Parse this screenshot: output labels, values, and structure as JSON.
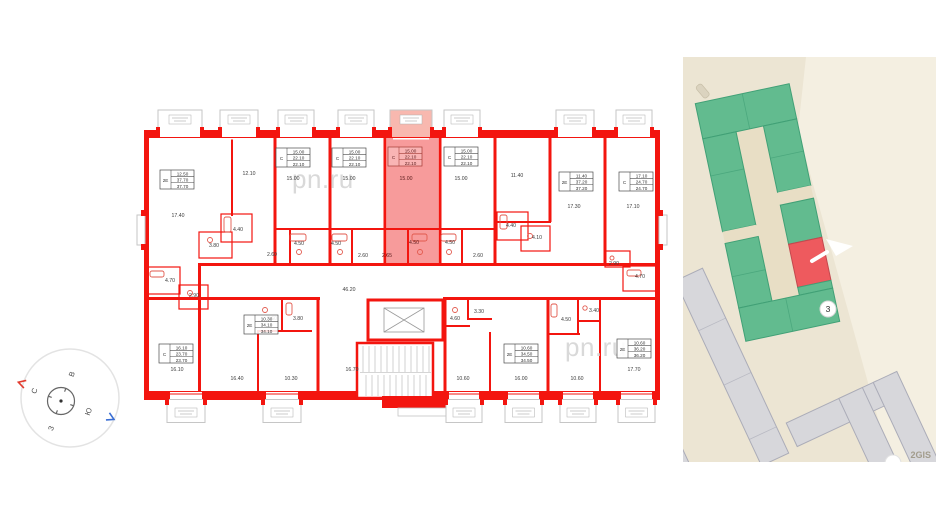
{
  "colors": {
    "wall": "#f3150f",
    "hl": "#f58282",
    "hlbal": "#f8b8af",
    "wm": "#d9d9d9",
    "map-bg": "#ece5d3",
    "map-road": "#f4efe1",
    "map-green": "#62bb8f",
    "map-green-border": "#41a076",
    "map-red": "#ee5a5e",
    "map-gray": "#d7d7db",
    "map-gray-border": "#abacb8"
  },
  "floorplan": {
    "watermarks": [
      "pn.ru",
      "pn.ru"
    ],
    "units": [
      {
        "t": "2Е",
        "a": "12.50",
        "b": "37.70",
        "c": "37.70",
        "x": 160,
        "y": 170
      },
      {
        "t": "С",
        "a": "15.00",
        "b": "22.10",
        "c": "22.10",
        "x": 276,
        "y": 148
      },
      {
        "t": "С",
        "a": "15.00",
        "b": "22.10",
        "c": "22.10",
        "x": 332,
        "y": 148
      },
      {
        "t": "С",
        "a": "15.00",
        "b": "22.10",
        "c": "22.10",
        "x": 388,
        "y": 147,
        "hl": true
      },
      {
        "t": "С",
        "a": "15.00",
        "b": "22.10",
        "c": "22.10",
        "x": 444,
        "y": 147
      },
      {
        "t": "2Е",
        "a": "11.40",
        "b": "37.20",
        "c": "37.20",
        "x": 559,
        "y": 172
      },
      {
        "t": "С",
        "a": "17.10",
        "b": "24.70",
        "c": "24.70",
        "x": 619,
        "y": 172
      },
      {
        "t": "С",
        "a": "16.10",
        "b": "23.70",
        "c": "23.70",
        "x": 159,
        "y": 344
      },
      {
        "t": "2Е",
        "a": "10.30",
        "b": "34.10",
        "c": "34.10",
        "x": 244,
        "y": 315
      },
      {
        "t": "2Е",
        "a": "10.60",
        "b": "34.50",
        "c": "34.50",
        "x": 504,
        "y": 344
      },
      {
        "t": "2Е",
        "a": "10.60",
        "b": "36.20",
        "c": "36.20",
        "x": 617,
        "y": 339
      }
    ],
    "room_areas": [
      {
        "v": "17.40",
        "x": 178,
        "y": 217
      },
      {
        "v": "12.10",
        "x": 249,
        "y": 175
      },
      {
        "v": "15.00",
        "x": 293,
        "y": 180
      },
      {
        "v": "15.00",
        "x": 349,
        "y": 180
      },
      {
        "v": "15.00",
        "x": 406,
        "y": 180,
        "hl": true
      },
      {
        "v": "15.00",
        "x": 461,
        "y": 180
      },
      {
        "v": "11.40",
        "x": 517,
        "y": 177
      },
      {
        "v": "17.30",
        "x": 574,
        "y": 208
      },
      {
        "v": "17.10",
        "x": 633,
        "y": 208
      },
      {
        "v": "4.40",
        "x": 238,
        "y": 231
      },
      {
        "v": "3.80",
        "x": 214,
        "y": 247
      },
      {
        "v": "2.60",
        "x": 272,
        "y": 256
      },
      {
        "v": "4.50",
        "x": 299,
        "y": 245
      },
      {
        "v": "4.50",
        "x": 336,
        "y": 245
      },
      {
        "v": "2.60",
        "x": 363,
        "y": 257
      },
      {
        "v": "2.65",
        "x": 387,
        "y": 257,
        "hl": true
      },
      {
        "v": "4.50",
        "x": 414,
        "y": 244,
        "hl": true
      },
      {
        "v": "4.50",
        "x": 450,
        "y": 244
      },
      {
        "v": "2.60",
        "x": 478,
        "y": 257
      },
      {
        "v": "4.40",
        "x": 511,
        "y": 227
      },
      {
        "v": "4.10",
        "x": 537,
        "y": 239
      },
      {
        "v": "2.90",
        "x": 614,
        "y": 265
      },
      {
        "v": "4.70",
        "x": 640,
        "y": 278
      },
      {
        "v": "4.70",
        "x": 170,
        "y": 282
      },
      {
        "v": "2.90",
        "x": 194,
        "y": 297
      },
      {
        "v": "46.20",
        "x": 349,
        "y": 291
      },
      {
        "v": "16.10",
        "x": 177,
        "y": 371
      },
      {
        "v": "16.40",
        "x": 237,
        "y": 380
      },
      {
        "v": "10.30",
        "x": 291,
        "y": 380
      },
      {
        "v": "3.60",
        "x": 272,
        "y": 320
      },
      {
        "v": "3.80",
        "x": 298,
        "y": 320
      },
      {
        "v": "16.70",
        "x": 352,
        "y": 371
      },
      {
        "v": "10.60",
        "x": 463,
        "y": 380
      },
      {
        "v": "16.00",
        "x": 521,
        "y": 380
      },
      {
        "v": "10.60",
        "x": 577,
        "y": 380
      },
      {
        "v": "4.60",
        "x": 455,
        "y": 320
      },
      {
        "v": "3.30",
        "x": 479,
        "y": 313
      },
      {
        "v": "4.50",
        "x": 566,
        "y": 321
      },
      {
        "v": "3.40",
        "x": 594,
        "y": 312
      },
      {
        "v": "17.70",
        "x": 634,
        "y": 371
      }
    ],
    "balconies": {
      "top": [
        {
          "x": 158,
          "w": 44
        },
        {
          "x": 220,
          "w": 38
        },
        {
          "x": 278,
          "w": 36
        },
        {
          "x": 338,
          "w": 36
        },
        {
          "x": 390,
          "w": 42,
          "hl": true
        },
        {
          "x": 444,
          "w": 36
        },
        {
          "x": 556,
          "w": 38
        },
        {
          "x": 616,
          "w": 36
        }
      ],
      "bottom": [
        {
          "x": 167,
          "w": 38
        },
        {
          "x": 263,
          "w": 38
        },
        {
          "x": 446,
          "w": 36
        },
        {
          "x": 505,
          "w": 37
        },
        {
          "x": 560,
          "w": 36
        },
        {
          "x": 618,
          "w": 37
        }
      ]
    }
  },
  "compass": {
    "letters": {
      "n": "С",
      "e": "В",
      "s": "Ю",
      "w": "З"
    }
  },
  "map": {
    "building_marker": "3",
    "attribution": "2GIS"
  }
}
